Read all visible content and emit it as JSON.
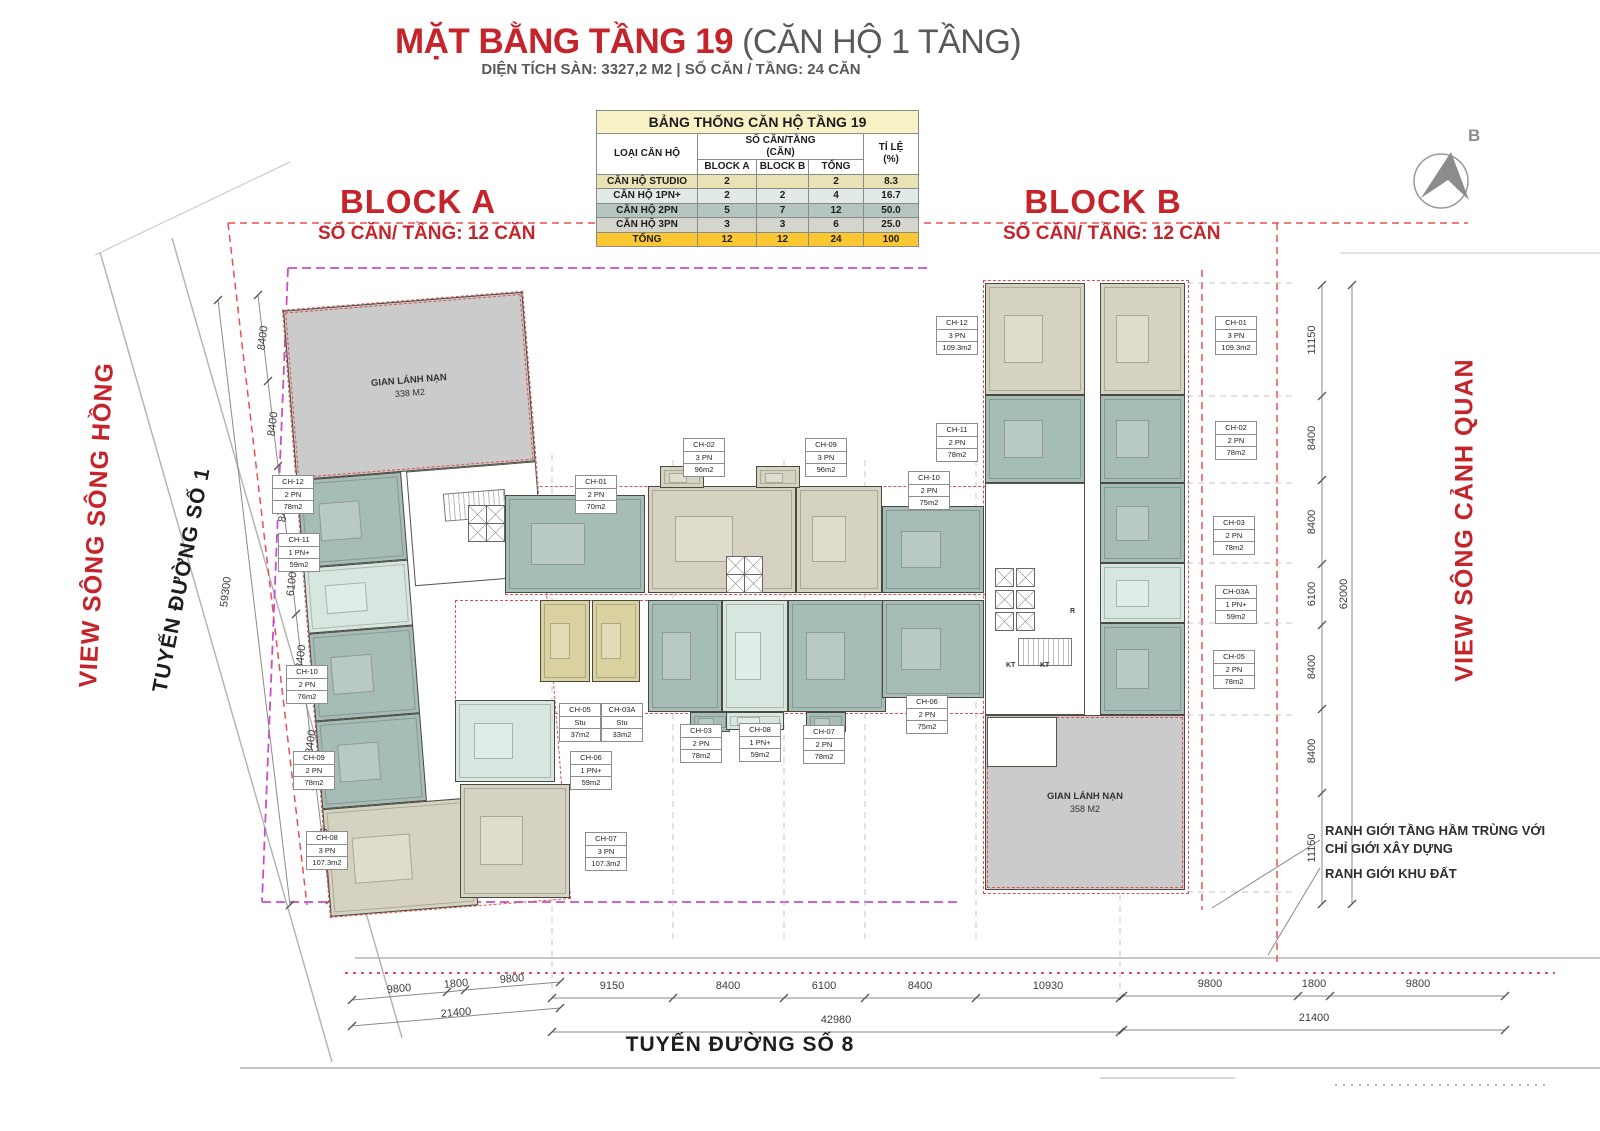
{
  "title": {
    "main": "MẶT BẰNG TẦNG 19",
    "suffix": " (CĂN HỘ 1 TẦNG)",
    "subtitle": "DIỆN TÍCH SÀN: 3327,2 M2 | SỐ CĂN / TẦNG: 24 CĂN"
  },
  "summary_table": {
    "title": "BẢNG THỐNG CĂN HỘ TẦNG 19",
    "headers": {
      "unit_type": "LOẠI CĂN HỘ",
      "count_line1": "SỐ CĂN/TẦNG",
      "count_line2": "(CĂN)",
      "block_a": "BLOCK A",
      "block_b": "BLOCK B",
      "total": "TỔNG",
      "ratio_line1": "TỈ LỆ",
      "ratio_line2": "(%)"
    },
    "rows": [
      {
        "type": "CĂN HỘ STUDIO",
        "block_a": "2",
        "block_b": "",
        "total": "2",
        "ratio": "8.3",
        "row_color": "#e8e2b4"
      },
      {
        "type": "CĂN HỘ 1PN+",
        "block_a": "2",
        "block_b": "2",
        "total": "4",
        "ratio": "16.7",
        "row_color": "#e1eae4"
      },
      {
        "type": "CĂN HỘ 2PN",
        "block_a": "5",
        "block_b": "7",
        "total": "12",
        "ratio": "50.0",
        "row_color": "#b5c6c0"
      },
      {
        "type": "CĂN HỘ 3PN",
        "block_a": "3",
        "block_b": "3",
        "total": "6",
        "ratio": "25.0",
        "row_color": "#d4d6cd"
      }
    ],
    "total_row": {
      "type": "TỔNG",
      "block_a": "12",
      "block_b": "12",
      "total": "24",
      "ratio": "100",
      "row_color": "#fcc832"
    }
  },
  "blocks": {
    "a": {
      "name": "BLOCK A",
      "subtitle": "SỐ CĂN/ TẦNG: 12 CĂN"
    },
    "b": {
      "name": "BLOCK B",
      "subtitle": "SỐ CĂN/ TẦNG: 12 CĂN"
    }
  },
  "compass": {
    "label": "B"
  },
  "street_labels": {
    "view_left": "VIEW SÔNG SÔNG HỒNG",
    "road_left": "TUYẾN ĐƯỜNG SỐ 1",
    "view_right": "VIEW SÔNG CẢNH QUAN",
    "road_bottom": "TUYẾN ĐƯỜNG SỐ 8"
  },
  "notes": {
    "line1": "RANH GIỚI TẦNG HẦM TRÙNG VỚI",
    "line2": "CHỈ GIỚI XÂY DỰNG",
    "line3": "RANH GIỚI KHU ĐẤT"
  },
  "refuges": [
    {
      "name": "GIAN LÁNH NẠN",
      "area": "338 M2"
    },
    {
      "name": "GIAN LÁNH NẠN",
      "area": "358 M2"
    }
  ],
  "core_labels": [
    {
      "text": "KT",
      "x": 1006,
      "y": 662
    },
    {
      "text": "KT",
      "x": 1040,
      "y": 662
    },
    {
      "text": "R",
      "x": 1070,
      "y": 608
    }
  ],
  "legend_colors": {
    "stu": "#d9d2a0",
    "pn1": "#d7e7e0",
    "pn2": "#a6bcb6",
    "pn3": "#d6d2c1",
    "refuge": "#cbcbcb"
  },
  "units": [
    {
      "block": "A",
      "id": "CH-12",
      "type": "2 PN",
      "area": "78m2",
      "cat": "pn2",
      "label": {
        "x": 272,
        "y": 475
      },
      "tilted": true,
      "rect": {
        "x": 0,
        "y": 170,
        "w": 105,
        "h": 88
      }
    },
    {
      "block": "A",
      "id": "CH-11",
      "type": "1 PN+",
      "area": "59m2",
      "cat": "pn1",
      "label": {
        "x": 278,
        "y": 533
      },
      "tilted": true,
      "rect": {
        "x": 0,
        "y": 258,
        "w": 105,
        "h": 66
      }
    },
    {
      "block": "A",
      "id": "CH-10",
      "type": "2 PN",
      "area": "76m2",
      "cat": "pn2",
      "label": {
        "x": 286,
        "y": 665
      },
      "tilted": true,
      "rect": {
        "x": 0,
        "y": 324,
        "w": 105,
        "h": 88
      }
    },
    {
      "block": "A",
      "id": "CH-09",
      "type": "2 PN",
      "area": "78m2",
      "cat": "pn2",
      "label": {
        "x": 293,
        "y": 751
      },
      "tilted": true,
      "rect": {
        "x": 0,
        "y": 412,
        "w": 105,
        "h": 88
      }
    },
    {
      "block": "A",
      "id": "CH-08",
      "type": "3 PN",
      "area": "107.3m2",
      "cat": "pn3",
      "label": {
        "x": 306,
        "y": 831
      },
      "tilted": true,
      "rect": {
        "x": 0,
        "y": 500,
        "w": 148,
        "h": 108
      }
    },
    {
      "block": "A",
      "id": "CH-01",
      "type": "2 PN",
      "area": "70m2",
      "cat": "pn2",
      "label": {
        "x": 575,
        "y": 475
      },
      "rect": {
        "x": 505,
        "y": 495,
        "w": 140,
        "h": 98
      }
    },
    {
      "block": "A",
      "id": "CH-02",
      "type": "3 PN",
      "area": "96m2",
      "cat": "pn3",
      "label": {
        "x": 683,
        "y": 438
      },
      "rect": {
        "x": 648,
        "y": 486,
        "w": 148,
        "h": 107
      }
    },
    {
      "block": "B",
      "id": "CH-09",
      "type": "3 PN",
      "area": "96m2",
      "cat": "pn3",
      "label": {
        "x": 805,
        "y": 438
      },
      "rect": {
        "x": 796,
        "y": 486,
        "w": 86,
        "h": 107
      }
    },
    {
      "block": "B",
      "id": "CH-10",
      "type": "2 PN",
      "area": "75m2",
      "cat": "pn2",
      "label": {
        "x": 908,
        "y": 471
      },
      "rect": {
        "x": 882,
        "y": 506,
        "w": 102,
        "h": 87
      }
    },
    {
      "block": "A",
      "id": "CH-05",
      "type": "Stu",
      "area": "37m2",
      "cat": "stu",
      "label": {
        "x": 559,
        "y": 703
      },
      "rect": {
        "x": 540,
        "y": 600,
        "w": 50,
        "h": 82
      }
    },
    {
      "block": "A",
      "id": "CH-03A",
      "type": "Stu",
      "area": "33m2",
      "cat": "stu",
      "label": {
        "x": 601,
        "y": 703
      },
      "rect": {
        "x": 592,
        "y": 600,
        "w": 48,
        "h": 82
      }
    },
    {
      "block": "A",
      "id": "CH-06",
      "type": "1 PN+",
      "area": "59m2",
      "cat": "pn1",
      "label": {
        "x": 570,
        "y": 751
      },
      "rect": {
        "x": 455,
        "y": 700,
        "w": 100,
        "h": 82
      }
    },
    {
      "block": "A",
      "id": "CH-07",
      "type": "3 PN",
      "area": "107.3m2",
      "cat": "pn3",
      "label": {
        "x": 585,
        "y": 832
      },
      "rect": {
        "x": 460,
        "y": 784,
        "w": 110,
        "h": 114
      }
    },
    {
      "block": "A",
      "id": "CH-03",
      "type": "2 PN",
      "area": "78m2",
      "cat": "pn2",
      "label": {
        "x": 680,
        "y": 724
      },
      "rect": {
        "x": 648,
        "y": 600,
        "w": 74,
        "h": 112
      }
    },
    {
      "block": "B",
      "id": "CH-08",
      "type": "1 PN+",
      "area": "59m2",
      "cat": "pn1",
      "label": {
        "x": 739,
        "y": 723
      },
      "rect": {
        "x": 722,
        "y": 600,
        "w": 66,
        "h": 112
      }
    },
    {
      "block": "B",
      "id": "CH-07",
      "type": "2 PN",
      "area": "78m2",
      "cat": "pn2",
      "label": {
        "x": 803,
        "y": 725
      },
      "rect": {
        "x": 788,
        "y": 600,
        "w": 98,
        "h": 112
      }
    },
    {
      "block": "B",
      "id": "CH-06",
      "type": "2 PN",
      "area": "75m2",
      "cat": "pn2",
      "label": {
        "x": 906,
        "y": 695
      },
      "rect": {
        "x": 882,
        "y": 600,
        "w": 102,
        "h": 98
      }
    },
    {
      "block": "B",
      "id": "CH-12",
      "type": "3 PN",
      "area": "109.3m2",
      "cat": "pn3",
      "label": {
        "x": 936,
        "y": 316
      },
      "rect": {
        "x": 985,
        "y": 283,
        "w": 100,
        "h": 112
      }
    },
    {
      "block": "B",
      "id": "CH-01",
      "type": "3 PN",
      "area": "109.3m2",
      "cat": "pn3",
      "label": {
        "x": 1215,
        "y": 316
      },
      "rect": {
        "x": 1100,
        "y": 283,
        "w": 85,
        "h": 112
      }
    },
    {
      "block": "B",
      "id": "CH-11",
      "type": "2 PN",
      "area": "78m2",
      "cat": "pn2",
      "label": {
        "x": 936,
        "y": 423
      },
      "rect": {
        "x": 985,
        "y": 395,
        "w": 100,
        "h": 88
      }
    },
    {
      "block": "B",
      "id": "CH-02",
      "type": "2 PN",
      "area": "78m2",
      "cat": "pn2",
      "label": {
        "x": 1215,
        "y": 421
      },
      "rect": {
        "x": 1100,
        "y": 395,
        "w": 85,
        "h": 88
      }
    },
    {
      "block": "B",
      "id": "CH-03",
      "type": "2 PN",
      "area": "78m2",
      "cat": "pn2",
      "label": {
        "x": 1213,
        "y": 516
      },
      "rect": {
        "x": 1100,
        "y": 483,
        "w": 85,
        "h": 80
      }
    },
    {
      "block": "B",
      "id": "CH-03A",
      "type": "1 PN+",
      "area": "59m2",
      "cat": "pn1",
      "label": {
        "x": 1215,
        "y": 585
      },
      "rect": {
        "x": 1100,
        "y": 563,
        "w": 85,
        "h": 60
      }
    },
    {
      "block": "B",
      "id": "CH-05",
      "type": "2 PN",
      "area": "78m2",
      "cat": "pn2",
      "label": {
        "x": 1213,
        "y": 650
      },
      "rect": {
        "x": 1100,
        "y": 623,
        "w": 85,
        "h": 92
      }
    }
  ],
  "dimensions": [
    {
      "v": "8400",
      "x": 263,
      "y": 338,
      "a": -83
    },
    {
      "v": "8400",
      "x": 273,
      "y": 424,
      "a": -83
    },
    {
      "v": "8400",
      "x": 284,
      "y": 510,
      "a": -83
    },
    {
      "v": "6100",
      "x": 292,
      "y": 584,
      "a": -83
    },
    {
      "v": "8400",
      "x": 301,
      "y": 657,
      "a": -83
    },
    {
      "v": "8400",
      "x": 311,
      "y": 742,
      "a": -83
    },
    {
      "v": "11200",
      "x": 323,
      "y": 843,
      "a": -83
    },
    {
      "v": "59300",
      "x": 226,
      "y": 592,
      "a": -83
    },
    {
      "v": "11150",
      "x": 1312,
      "y": 340,
      "a": -90
    },
    {
      "v": "8400",
      "x": 1312,
      "y": 438,
      "a": -90
    },
    {
      "v": "8400",
      "x": 1312,
      "y": 522,
      "a": -90
    },
    {
      "v": "6100",
      "x": 1312,
      "y": 594,
      "a": -90
    },
    {
      "v": "8400",
      "x": 1312,
      "y": 667,
      "a": -90
    },
    {
      "v": "8400",
      "x": 1312,
      "y": 751,
      "a": -90
    },
    {
      "v": "11150",
      "x": 1312,
      "y": 848,
      "a": -90
    },
    {
      "v": "62000",
      "x": 1344,
      "y": 594,
      "a": -90
    },
    {
      "v": "9800",
      "x": 399,
      "y": 989,
      "a": -5
    },
    {
      "v": "1800",
      "x": 456,
      "y": 984,
      "a": -5
    },
    {
      "v": "9800",
      "x": 512,
      "y": 979,
      "a": -5
    },
    {
      "v": "21400",
      "x": 456,
      "y": 1013,
      "a": -5
    },
    {
      "v": "9150",
      "x": 612,
      "y": 986,
      "a": 0
    },
    {
      "v": "8400",
      "x": 728,
      "y": 986,
      "a": 0
    },
    {
      "v": "6100",
      "x": 824,
      "y": 986,
      "a": 0
    },
    {
      "v": "8400",
      "x": 920,
      "y": 986,
      "a": 0
    },
    {
      "v": "10930",
      "x": 1048,
      "y": 986,
      "a": 0
    },
    {
      "v": "42980",
      "x": 836,
      "y": 1020,
      "a": 0
    },
    {
      "v": "9800",
      "x": 1210,
      "y": 984,
      "a": 0
    },
    {
      "v": "1800",
      "x": 1314,
      "y": 984,
      "a": 0
    },
    {
      "v": "9800",
      "x": 1418,
      "y": 984,
      "a": 0
    },
    {
      "v": "21400",
      "x": 1314,
      "y": 1018,
      "a": 0
    }
  ]
}
